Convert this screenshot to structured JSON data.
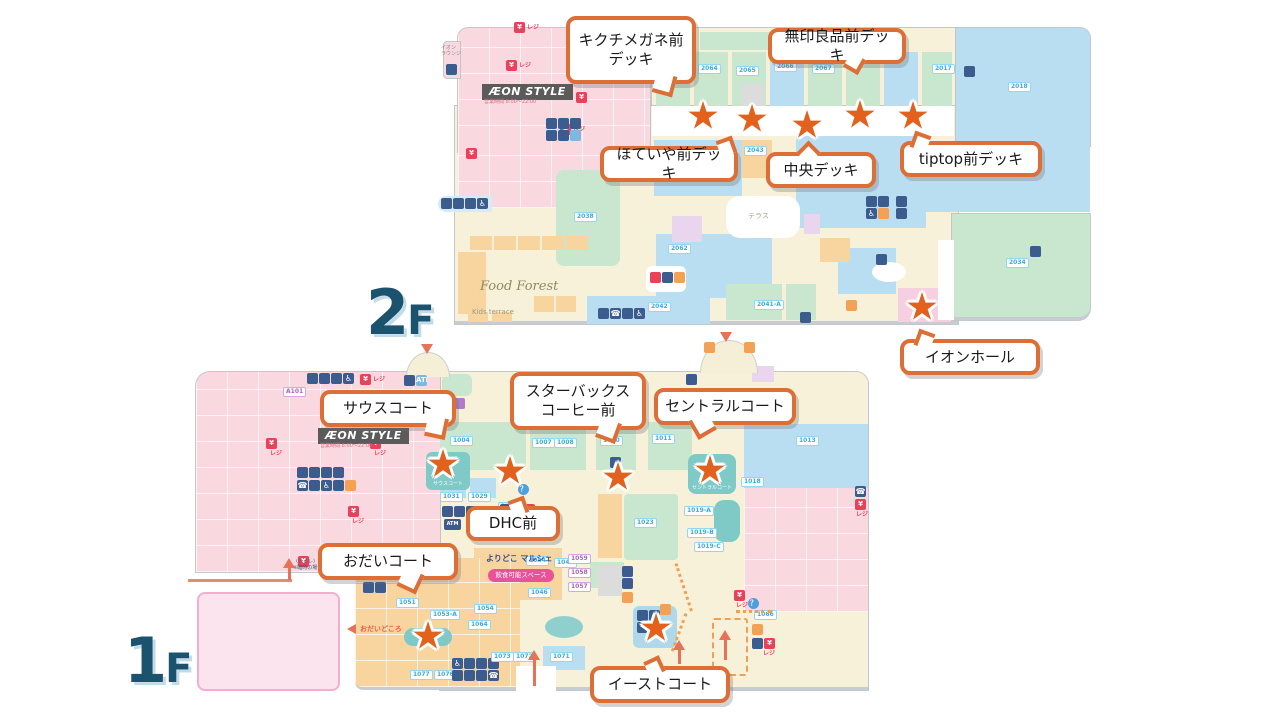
{
  "icons": {
    "star": "★",
    "yen": "¥",
    "reji": "レジ",
    "wheelchair": "♿",
    "phone": "☎",
    "question": "？",
    "atm": "ATM"
  },
  "floors": {
    "f2": {
      "num": "2",
      "suffix": "F"
    },
    "f1": {
      "num": "1",
      "suffix": "F"
    }
  },
  "callouts": {
    "kikuchi": {
      "text": "キクチメガネ前\nデッキ"
    },
    "muji": {
      "text": "無印良品前デッキ"
    },
    "hoteiya": {
      "text": "ほていや前デッキ"
    },
    "chuo": {
      "text": "中央デッキ"
    },
    "tiptop": {
      "text": "tiptop前デッキ"
    },
    "hall": {
      "text": "イオンホール"
    },
    "south": {
      "text": "サウスコート"
    },
    "starbucks": {
      "text": "スターバックス\nコーヒー前"
    },
    "central": {
      "text": "セントラルコート"
    },
    "dhc": {
      "text": "DHC前"
    },
    "odai": {
      "text": "おだいコート"
    },
    "east": {
      "text": "イーストコート"
    }
  },
  "maps": {
    "f2": {
      "aeon_label": "ÆON STYLE",
      "aeon_hours": "営業時間 8:00〜22:00",
      "lounge": "イオン\nラウンジ",
      "food_forest": "Food Forest",
      "kids_terrace": "Kids terrace",
      "terrace": "テラス",
      "units": [
        "2063",
        "2064",
        "2065",
        "2066",
        "2067",
        "2038",
        "2017",
        "2018",
        "2034",
        "2041-A",
        "2043",
        "2042",
        "2062",
        "2035"
      ]
    },
    "f1": {
      "aeon_label": "ÆON STYLE",
      "aeon_hours": "営業時間 8:00〜22:00",
      "yoridoko": "よりどこ マルシェ",
      "inshoku": "飲食可能スペース",
      "odaidokoro": "おだいどころ",
      "toilet_note": "〈トイレ〉8:00〜10:00\n※臨時の場合を除く",
      "south_court": "サウスコート",
      "central_court": "セントラルコート",
      "units": [
        "1004",
        "1007",
        "1008",
        "1010",
        "1011",
        "1013",
        "1018",
        "1023",
        "1029",
        "1031",
        "1037",
        "1043",
        "1044",
        "1046",
        "1051",
        "1053-A",
        "1054",
        "1057",
        "1058",
        "1059",
        "1064",
        "1066",
        "1071",
        "1072",
        "1073",
        "1076",
        "1077",
        "1019-A",
        "1019-B",
        "1019-C",
        "A101"
      ]
    }
  }
}
